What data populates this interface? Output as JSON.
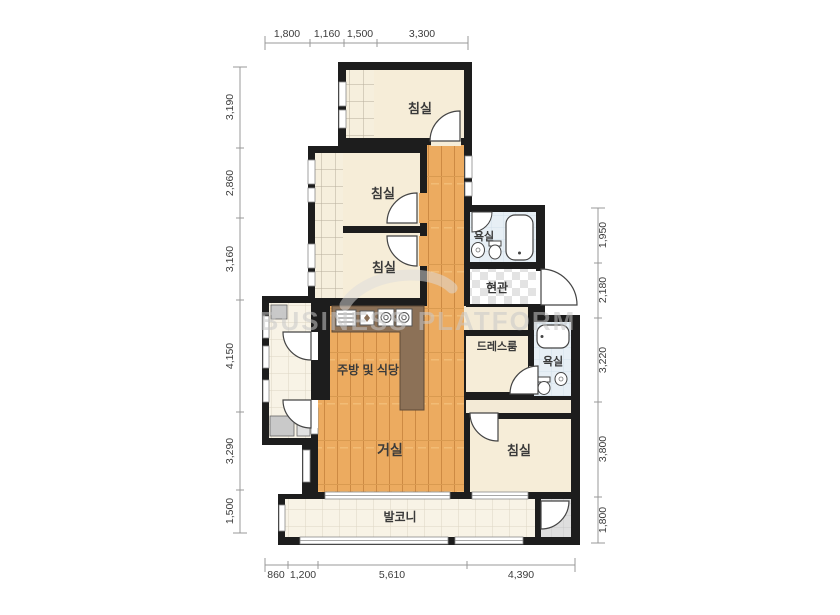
{
  "plan": {
    "watermark_text": "BUSINESS PLATFORM",
    "rooms": {
      "bedroom_top": "침실",
      "bedroom_mid_upper": "침실",
      "bedroom_mid_lower": "침실",
      "bath_upper": "욕실",
      "entrance": "현관",
      "dress_room": "드레스룸",
      "bath_lower": "욕실",
      "kitchen_dining": "주방 및 식당",
      "living_room": "거실",
      "bedroom_right": "침실",
      "balcony": "발코니"
    },
    "dimensions": {
      "top": [
        "1,800",
        "1,160",
        "1,500",
        "3,300"
      ],
      "left": [
        "3,190",
        "2,860",
        "3,160",
        "4,150",
        "3,290",
        "1,500"
      ],
      "right": [
        "1,950",
        "2,180",
        "3,220",
        "3,800",
        "1,800"
      ],
      "bottom": [
        "860",
        "1,200",
        "5,610",
        "4,390"
      ]
    },
    "colors": {
      "wall": "#1d1d1d",
      "wood_floor": "#ecab60",
      "room_cream": "#f6edd8",
      "bath_tile": "#e7eff5",
      "counter": "#8c7157",
      "balcony_tile": "#f8f3e6"
    }
  }
}
